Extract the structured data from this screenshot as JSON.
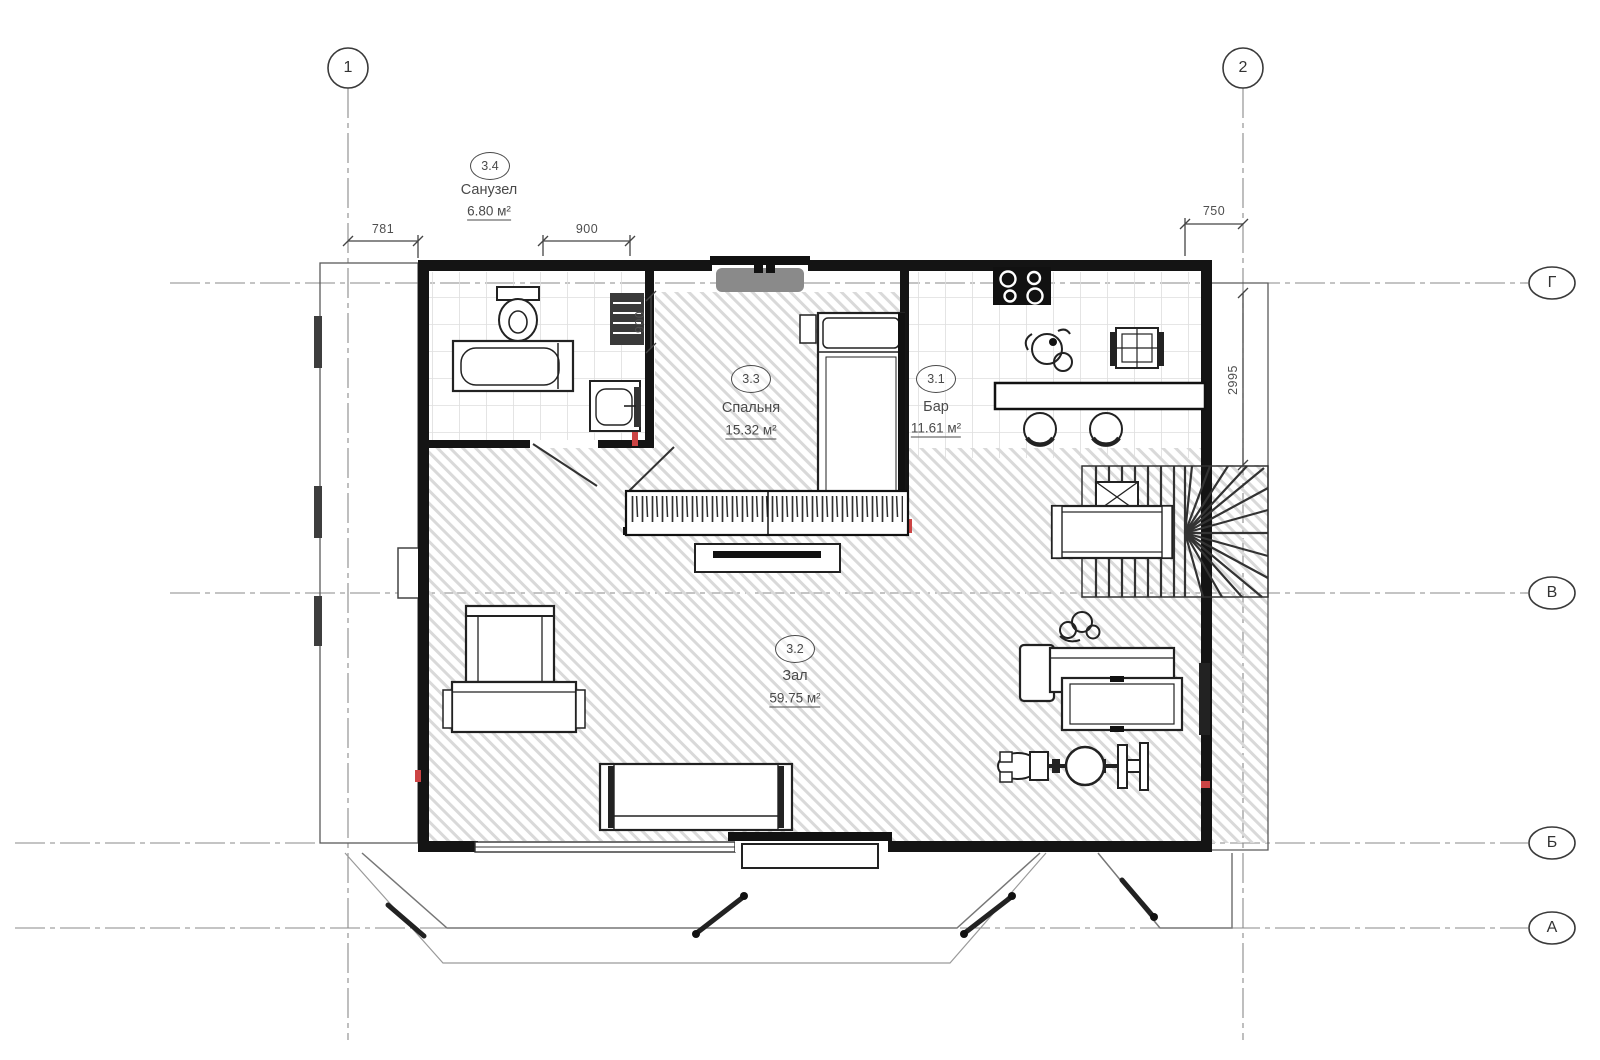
{
  "axes": {
    "vertical": [
      {
        "label": "1"
      },
      {
        "label": "2"
      }
    ],
    "horizontal": [
      {
        "label": "Г"
      },
      {
        "label": "В"
      },
      {
        "label": "Б"
      },
      {
        "label": "А"
      }
    ]
  },
  "dimensions": {
    "top_left": "781",
    "top_middle": "900",
    "top_right": "750",
    "bathroom_vertical": "900",
    "right_vertical": "2995"
  },
  "rooms": [
    {
      "number": "3.4",
      "name": "Санузел",
      "area": "6.80 м²"
    },
    {
      "number": "3.3",
      "name": "Спальня",
      "area": "15.32 м²"
    },
    {
      "number": "3.1",
      "name": "Бар",
      "area": "11.61 м²"
    },
    {
      "number": "3.2",
      "name": "Зал",
      "area": "59.75 м²"
    }
  ]
}
